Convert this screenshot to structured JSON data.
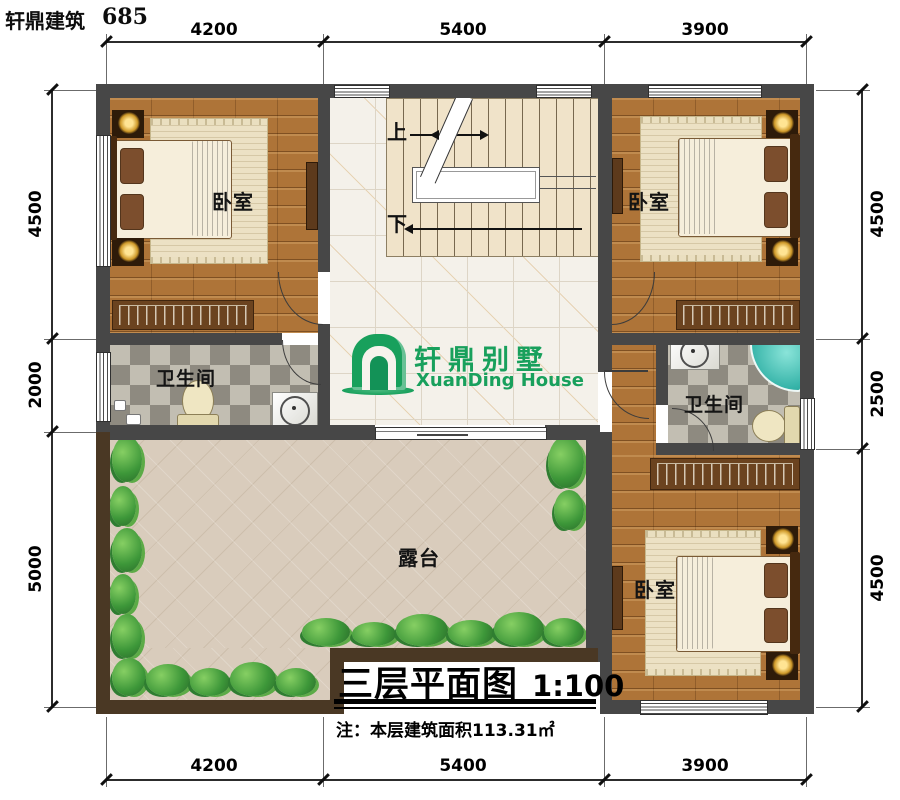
{
  "header": {
    "brand": "轩鼎建筑",
    "number": "685"
  },
  "logo": {
    "cn": "轩鼎别墅",
    "en": "XuanDing House"
  },
  "rooms": {
    "bedroom_tl": "卧室",
    "bedroom_tr": "卧室",
    "bedroom_br": "卧室",
    "bathroom_left": "卫生间",
    "bathroom_right": "卫生间",
    "terrace": "露台"
  },
  "stairs": {
    "up": "上",
    "down": "下"
  },
  "dimensions": {
    "top": [
      "4200",
      "5400",
      "3900"
    ],
    "bottom": [
      "4200",
      "5400",
      "3900"
    ],
    "left": [
      "4500",
      "2000",
      "5000"
    ],
    "right": [
      "4500",
      "2500",
      "4500"
    ]
  },
  "title_block": {
    "title": "三层平面图",
    "scale": "1:100",
    "note": "注：本层建筑面积113.31㎡"
  },
  "colors": {
    "wall": "#474747",
    "terrace_wall": "#4a3824",
    "logo_green": "#18a05c",
    "wood_floor": "#ae7438",
    "tub_teal": "#35b3a8"
  }
}
